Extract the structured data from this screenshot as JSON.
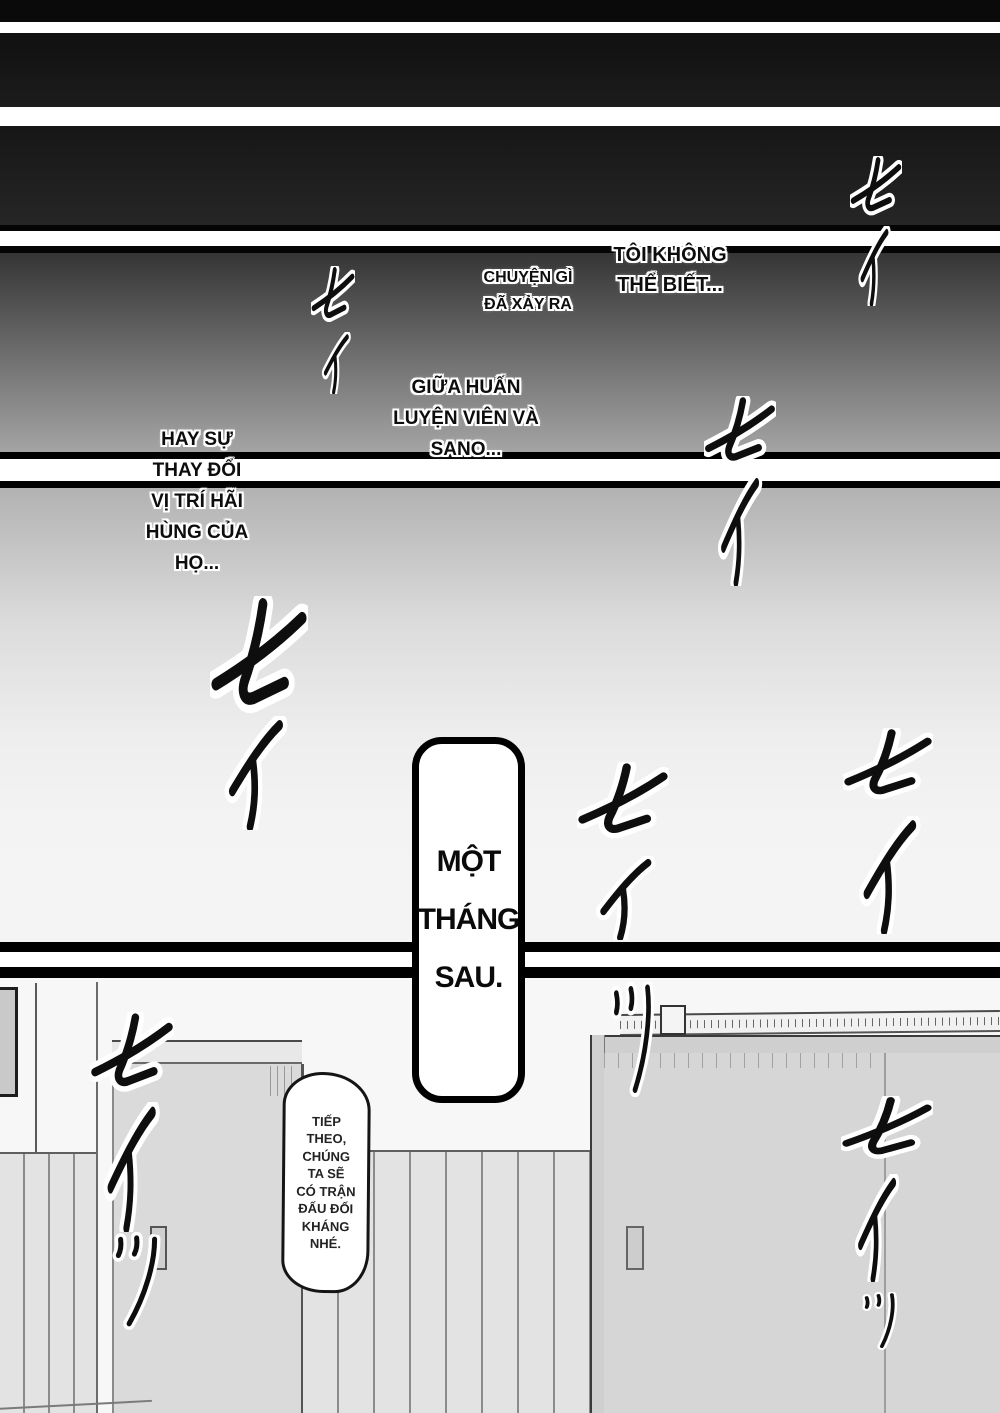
{
  "page": {
    "kind": "manga page",
    "captions": {
      "c1": {
        "lines": [
          "TÔI KHÔNG",
          "THỂ BIẾT..."
        ]
      },
      "c2": {
        "lines": [
          "CHUYỆN GÌ",
          "ĐÃ XẢY RA"
        ]
      },
      "c3": {
        "lines": [
          "GIỮA HUẤN",
          "LUYỆN VIÊN VÀ",
          "SANO..."
        ]
      },
      "c4": {
        "lines": [
          "HAY SỰ",
          "THAY ĐỔI",
          "VỊ TRÍ HÃI",
          "HÙNG CỦA",
          "HỌ..."
        ]
      }
    },
    "bubbles": {
      "time": {
        "lines": [
          "MỘT",
          "THÁNG",
          "SAU."
        ]
      },
      "speech": {
        "lines": [
          "TIẾP",
          "THEO,",
          "CHÚNG",
          "TA SẼ",
          "CÓ TRẬN",
          "ĐẤU ĐỐI",
          "KHÁNG",
          "NHÉ."
        ]
      }
    },
    "sfx_meaning": "セイ / セイッ (sei) kiai shout sound effects",
    "sfx": [
      {
        "glyph": "se",
        "x": 850,
        "y": 156,
        "w": 52,
        "h": 70,
        "rot": 0
      },
      {
        "glyph": "i",
        "x": 854,
        "y": 226,
        "w": 38,
        "h": 80,
        "rot": 0
      },
      {
        "glyph": "se",
        "x": 311,
        "y": 266,
        "w": 44,
        "h": 66,
        "rot": 0
      },
      {
        "glyph": "i",
        "x": 318,
        "y": 332,
        "w": 34,
        "h": 62,
        "rot": 0
      },
      {
        "glyph": "se",
        "x": 704,
        "y": 396,
        "w": 72,
        "h": 82,
        "rot": 0
      },
      {
        "glyph": "i",
        "x": 712,
        "y": 474,
        "w": 52,
        "h": 112,
        "rot": 0
      },
      {
        "glyph": "se",
        "x": 210,
        "y": 596,
        "w": 98,
        "h": 138,
        "rot": 0
      },
      {
        "glyph": "i",
        "x": 216,
        "y": 716,
        "w": 74,
        "h": 114,
        "rot": 0
      },
      {
        "glyph": "se",
        "x": 577,
        "y": 762,
        "w": 92,
        "h": 90,
        "rot": 0
      },
      {
        "glyph": "i",
        "x": 588,
        "y": 856,
        "w": 70,
        "h": 84,
        "rot": 0
      },
      {
        "glyph": "tsu",
        "x": 608,
        "y": 982,
        "w": 52,
        "h": 115,
        "rot": 0
      },
      {
        "glyph": "se",
        "x": 843,
        "y": 728,
        "w": 90,
        "h": 84,
        "rot": 0
      },
      {
        "glyph": "i",
        "x": 851,
        "y": 816,
        "w": 72,
        "h": 118,
        "rot": 0
      },
      {
        "glyph": "se",
        "x": 90,
        "y": 1012,
        "w": 84,
        "h": 94,
        "rot": 0
      },
      {
        "glyph": "i",
        "x": 96,
        "y": 1102,
        "w": 66,
        "h": 130,
        "rot": 0
      },
      {
        "glyph": "tsu",
        "x": 106,
        "y": 1232,
        "w": 56,
        "h": 98,
        "rot": 8
      },
      {
        "glyph": "se",
        "x": 841,
        "y": 1096,
        "w": 92,
        "h": 74,
        "rot": 0
      },
      {
        "glyph": "i",
        "x": 849,
        "y": 1174,
        "w": 52,
        "h": 108,
        "rot": 0
      },
      {
        "glyph": "tsu",
        "x": 860,
        "y": 1292,
        "w": 42,
        "h": 58,
        "rot": 0
      }
    ]
  }
}
